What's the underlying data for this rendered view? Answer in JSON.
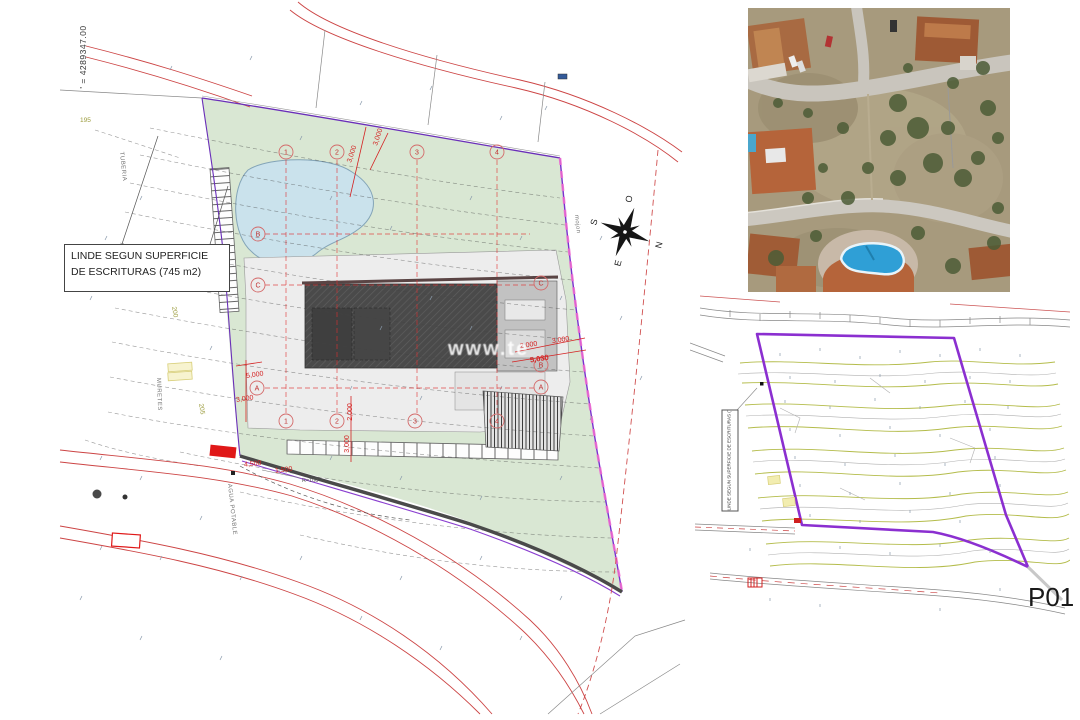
{
  "sheet": {
    "label": "P01"
  },
  "main_plan": {
    "coordinate_label": "' = 4289347.00",
    "note_line1": "LINDE SEGUN SUPERFICIE",
    "note_line2": "DE ESCRITURAS (745 m2)",
    "watermark": "www.te",
    "labels": {
      "tuberia": "TUBERIA",
      "muretes": "MURETES",
      "mojon": "mojon",
      "agua_potable": "AGUA POTABLE"
    },
    "contour_labels": {
      "c195": "195",
      "c200": "200",
      "c205": "205"
    },
    "grid": {
      "n1": "1",
      "n2": "2",
      "n3": "3",
      "n4": "4",
      "lA": "A",
      "lB": "B",
      "lC": "C"
    },
    "dims": {
      "top_a": "3,000",
      "top_b": "3,000",
      "right_a": "2,000",
      "right_b": "3,000",
      "right_c": "5,030",
      "left_a": "5,000",
      "left_b": "3,000",
      "bottom_a": "2,000",
      "bottom_b": "3,000",
      "road_a": "4,500",
      "road_b": "1,500",
      "radius": "R=100"
    }
  },
  "compass": {
    "n": "N",
    "s": "S",
    "e": "E",
    "o": "O"
  },
  "detail_plan": {
    "note_text": "LINDE SEGUN SUPERFICIE DE ESCRITURAS (745 m2)"
  }
}
